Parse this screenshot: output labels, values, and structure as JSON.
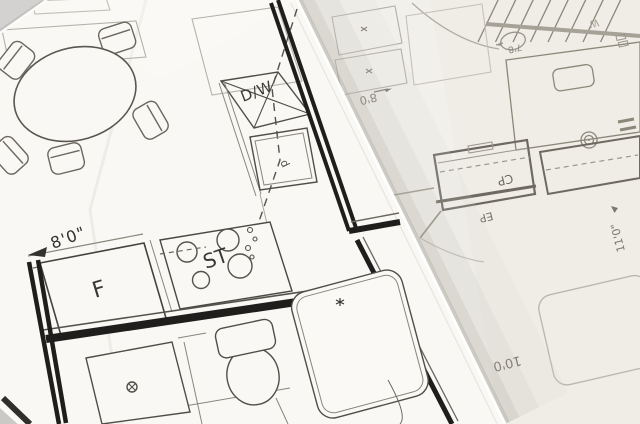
{
  "scene": {
    "description": "Photograph of two overlapping architectural floor plan blueprint sheets",
    "left_sheet": "Front sheet: kitchen with dining table, bathroom with shower, toilet and tub",
    "right_sheet": "Back sheet (rotated upside down): bedroom with bed, stairs, closets"
  },
  "left_plan": {
    "dishwasher_label": "D/W",
    "sink_label": "d",
    "stove_label": "ST",
    "refrigerator_label": "F",
    "kitchen_width_dim": "8'0\""
  },
  "right_plan": {
    "closet_label": "CP",
    "panel_label": "EP",
    "dim_8": "8'0",
    "dim_10": "10'0",
    "dim_11": "11'0\"",
    "dim_7_8": "7'8",
    "faint_letter": "W"
  },
  "colors": {
    "background": "#d7d6d4",
    "left_paper": "#f9f8f4",
    "right_paper": "#f2f0ea",
    "ink_dark": "#1f1e1c",
    "ink_medium": "#514e48",
    "ink_faint_right": "#8b8779",
    "edge_shadow": "#b8b5ad",
    "paper_edge_highlight": "#fefefc"
  }
}
